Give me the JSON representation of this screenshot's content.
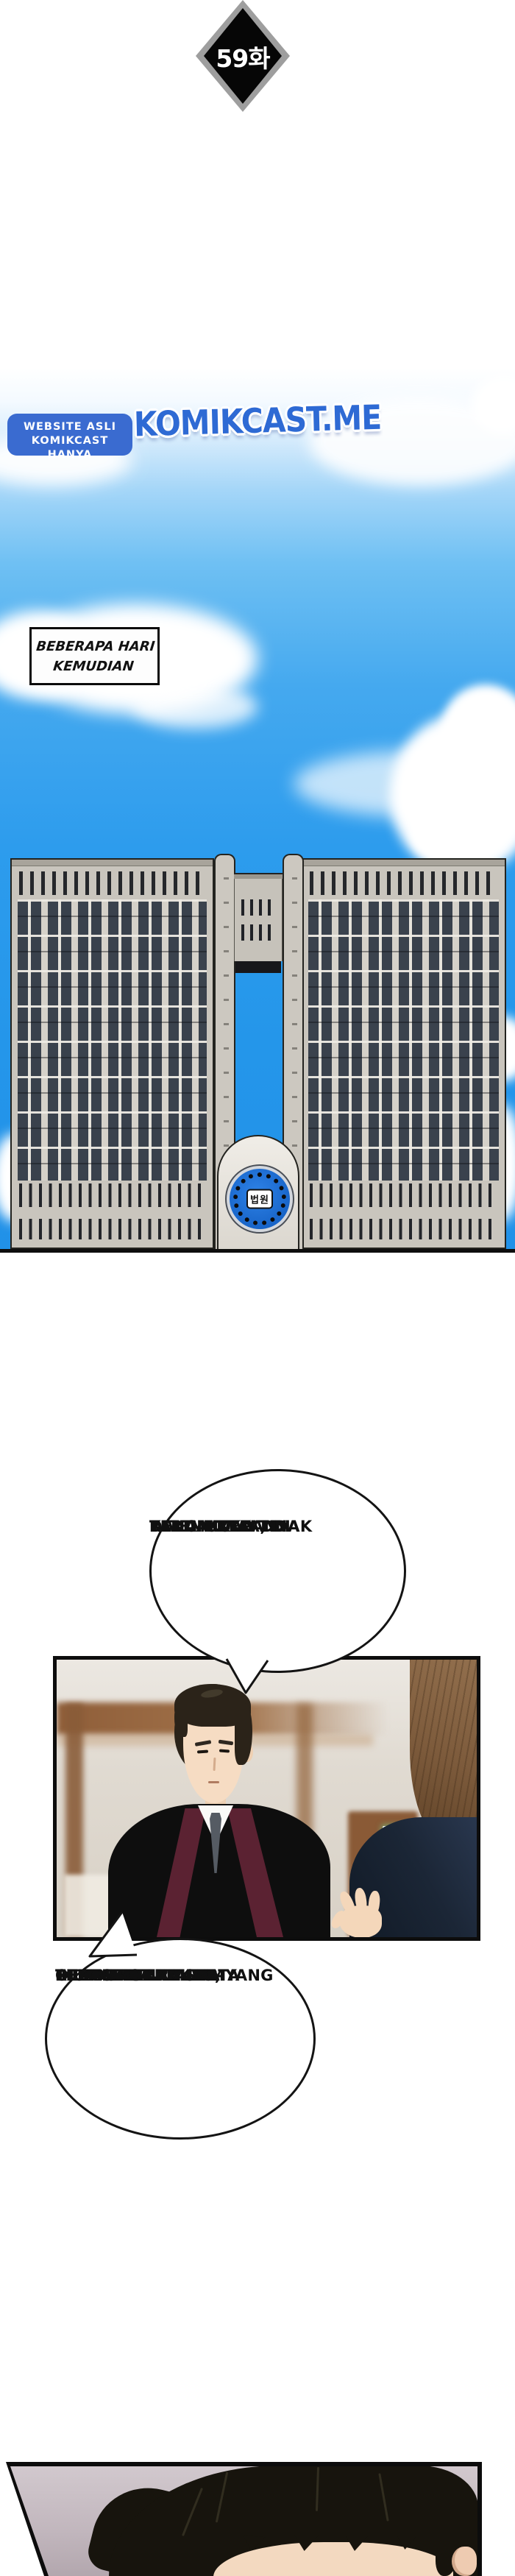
{
  "episode_badge": {
    "label": "59화",
    "fill": "#060606",
    "rim": "#9e9e9e"
  },
  "watermark": {
    "box_line1": "WEBSITE ASLI",
    "box_line2": "KOMIKCAST HANYA",
    "box_color": "#3a6bd0",
    "site": "KOMIKCAST.ME",
    "site_color": "#2e6ad4"
  },
  "scene_caption": {
    "line1": "BEBERAPA HARI",
    "line2": "KEMUDIAN"
  },
  "courthouse": {
    "emblem_text": "법원",
    "emblem_blue": "#1565d8",
    "facade_color": "#c9c5bd",
    "sky_top": "#ffffff",
    "sky_mid": "#6fc0f3",
    "sky_deep": "#2496ea"
  },
  "bubble1": {
    "lines": [
      "YANG MULIA, DI",
      "DALAM TKP TIDAK",
      "DITEMUKAN DNA",
      "REKAN-REKAN",
      "TERDAKWA."
    ]
  },
  "bubble2": {
    "lines": [
      "OLEH KARENA ITU,",
      "TIDAK ADA REKAN-",
      "REKAN TERDAKWA YANG",
      "IKUT SERTA DALAM",
      "PERAMPOKAN SERTA",
      "PEMBUNUHAN INI."
    ]
  },
  "judge_scene": {
    "robe_black": "#0e0e0e",
    "lapel_maroon": "#5b2232",
    "tie_gray": "#555b63",
    "suit_navy": "#1b2636",
    "exit_sign_green": "#44c167",
    "wood_brown": "#8f5e39"
  }
}
